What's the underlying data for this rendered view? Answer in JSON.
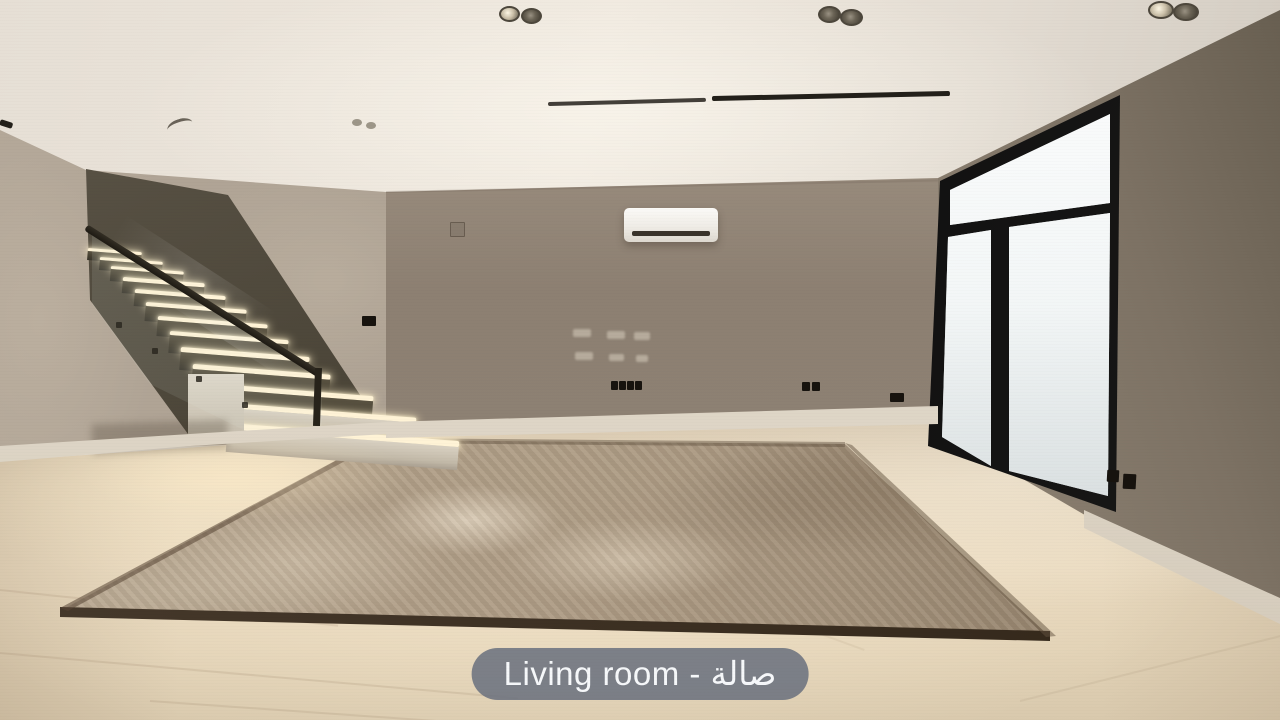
{
  "photo": {
    "caption": "Living room - صالة"
  },
  "scene": {
    "objects": [
      "staircase-with-led-step-lighting",
      "glass-balustrade-with-dark-handrail",
      "split-air-conditioner",
      "black-framed-sliding-glass-door",
      "beige-area-rug",
      "recessed-ceiling-spotlights",
      "linear-ceiling-diffuser-slots",
      "wall-sockets",
      "white-baseboards"
    ]
  },
  "colors": {
    "caption_bg": "rgba(104,112,126,0.85)",
    "caption_text": "#f6f8fa",
    "led": "#fff3d6",
    "wall": "#9a8d7e",
    "ceiling": "#e9e2d8",
    "floor": "#e5d5bb",
    "rug": "#ab9982",
    "door_frame": "#161616"
  }
}
